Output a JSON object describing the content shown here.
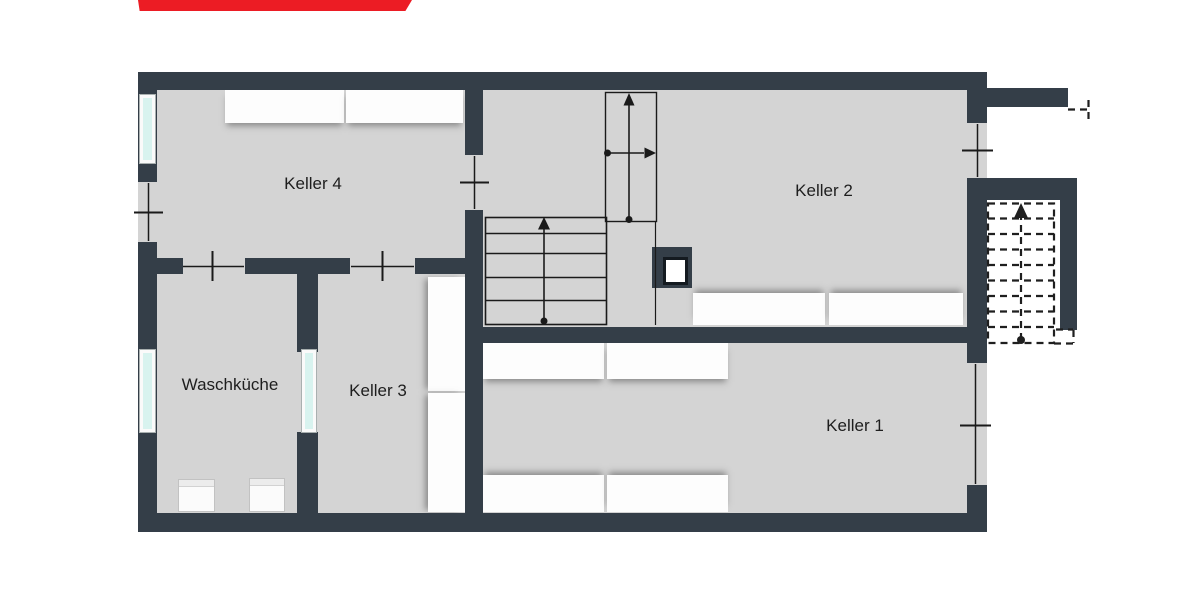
{
  "banner": {
    "color": "#ec1c24"
  },
  "colors": {
    "wall": "#343e48",
    "floor": "#d4d4d4",
    "window_glass": "#d8f3ef",
    "outline": "#1a1a1a",
    "shelf": "#fdfdfd",
    "background": "#ffffff",
    "banner_red": "#ec1c24"
  },
  "rooms": {
    "keller4": {
      "label": "Keller 4"
    },
    "keller2": {
      "label": "Keller 2"
    },
    "keller3": {
      "label": "Keller 3"
    },
    "keller1": {
      "label": "Keller 1"
    },
    "waschkueche": {
      "label": "Waschküche"
    }
  }
}
